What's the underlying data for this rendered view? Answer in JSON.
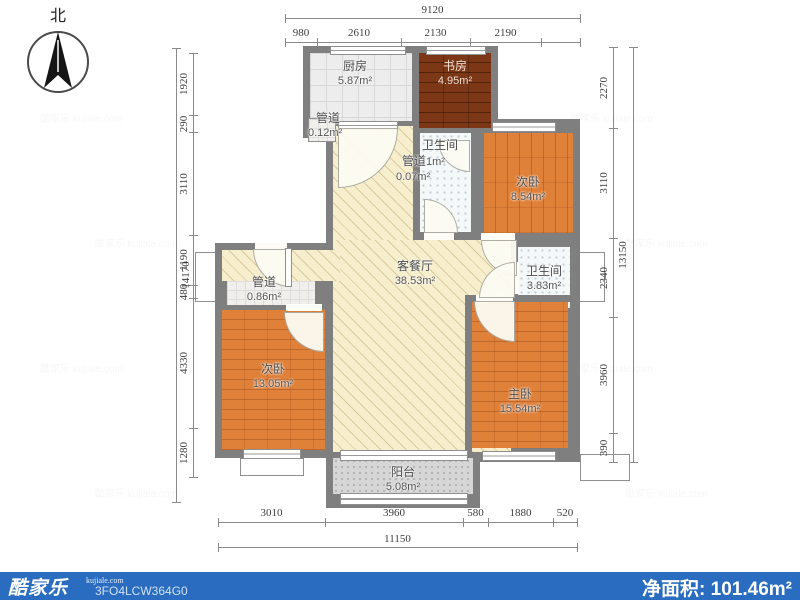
{
  "meta": {
    "north_label": "北"
  },
  "watermark": "酷家乐 kujiale.com",
  "rooms": [
    {
      "name": "厨房",
      "area": "5.87m²"
    },
    {
      "name": "书房",
      "area": "4.95m²"
    },
    {
      "name": "管道",
      "area": "0.12m²"
    },
    {
      "name": "卫生间",
      "area": "1m²"
    },
    {
      "name": "管道",
      "area": "0.07m²"
    },
    {
      "name": "次卧",
      "area": "8.54m²"
    },
    {
      "name": "客餐厅",
      "area": "38.53m²"
    },
    {
      "name": "卫生间",
      "area": "3.83m²"
    },
    {
      "name": "管道",
      "area": "0.86m²"
    },
    {
      "name": "次卧",
      "area": "13.05m²"
    },
    {
      "name": "主卧",
      "area": "15.54m²"
    },
    {
      "name": "阳台",
      "area": "5.08m²"
    }
  ],
  "dimensions": {
    "top": {
      "total": "9120",
      "segments": [
        "980",
        "2610",
        "2130",
        "2190"
      ]
    },
    "left": {
      "total": "14170",
      "segments": [
        "1920",
        "290",
        "3110",
        "1190",
        "480",
        "4330",
        "1280"
      ]
    },
    "right": {
      "total": "13150",
      "segments": [
        "2270",
        "3110",
        "2340",
        "3960",
        "390"
      ]
    },
    "bottom": {
      "total": "11150",
      "segments": [
        "3010",
        "3960",
        "580",
        "1880",
        "520"
      ]
    }
  },
  "footer": {
    "logo": "酷家乐",
    "logo_sub": "kujiale.com",
    "code": "3FO4LCW364G0",
    "net_area_label": "净面积:",
    "net_area_value": "101.46m²",
    "bar_color": "#2a6cbf"
  }
}
